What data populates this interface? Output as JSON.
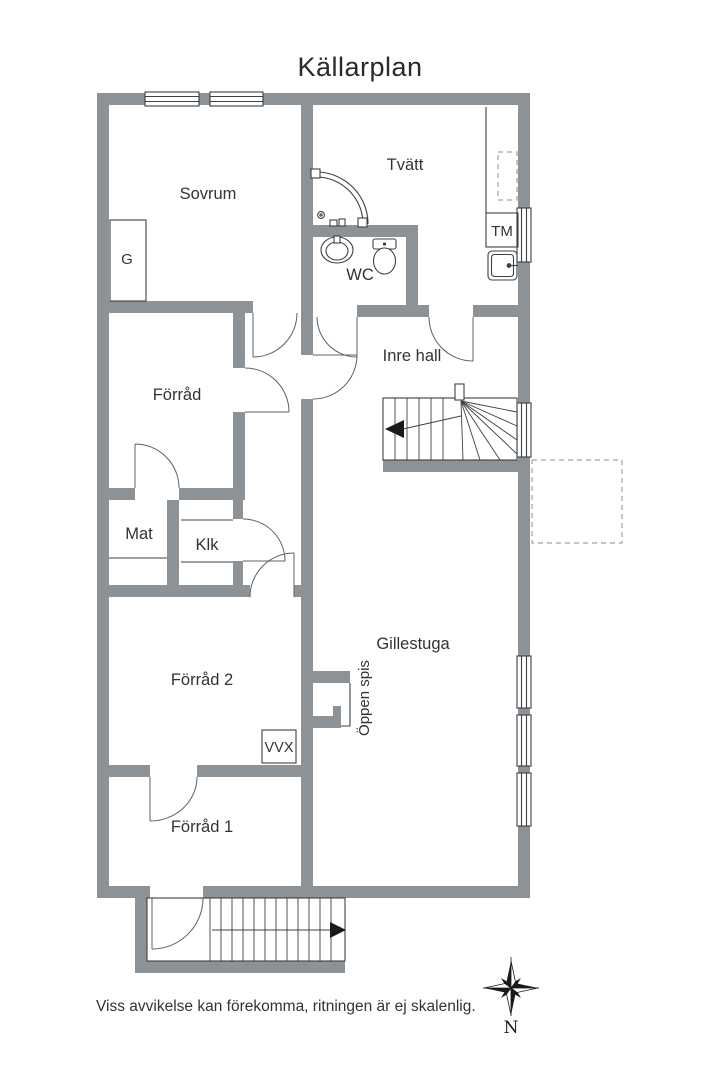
{
  "title": "Källarplan",
  "rooms": {
    "sovrum": "Sovrum",
    "tvatt": "Tvätt",
    "wc": "WC",
    "inre_hall": "Inre hall",
    "forrad": "Förråd",
    "mat": "Mat",
    "klk": "Klk",
    "forrad2": "Förråd 2",
    "gillestuga": "Gillestuga",
    "forrad1": "Förråd 1"
  },
  "fixtures": {
    "garderob": "G",
    "tvattmaskin": "TM",
    "varmevaxlare": "VVX",
    "oppen_spis": "Öppen spis"
  },
  "compass": {
    "north": "N"
  },
  "disclaimer": "Viss avvikelse kan förekomma, ritningen är ej skalenlig.",
  "colors": {
    "wall": "#8d9296",
    "line": "#3c4043",
    "text": "#333333",
    "dashed": "#9ea3a6",
    "background": "#ffffff"
  }
}
